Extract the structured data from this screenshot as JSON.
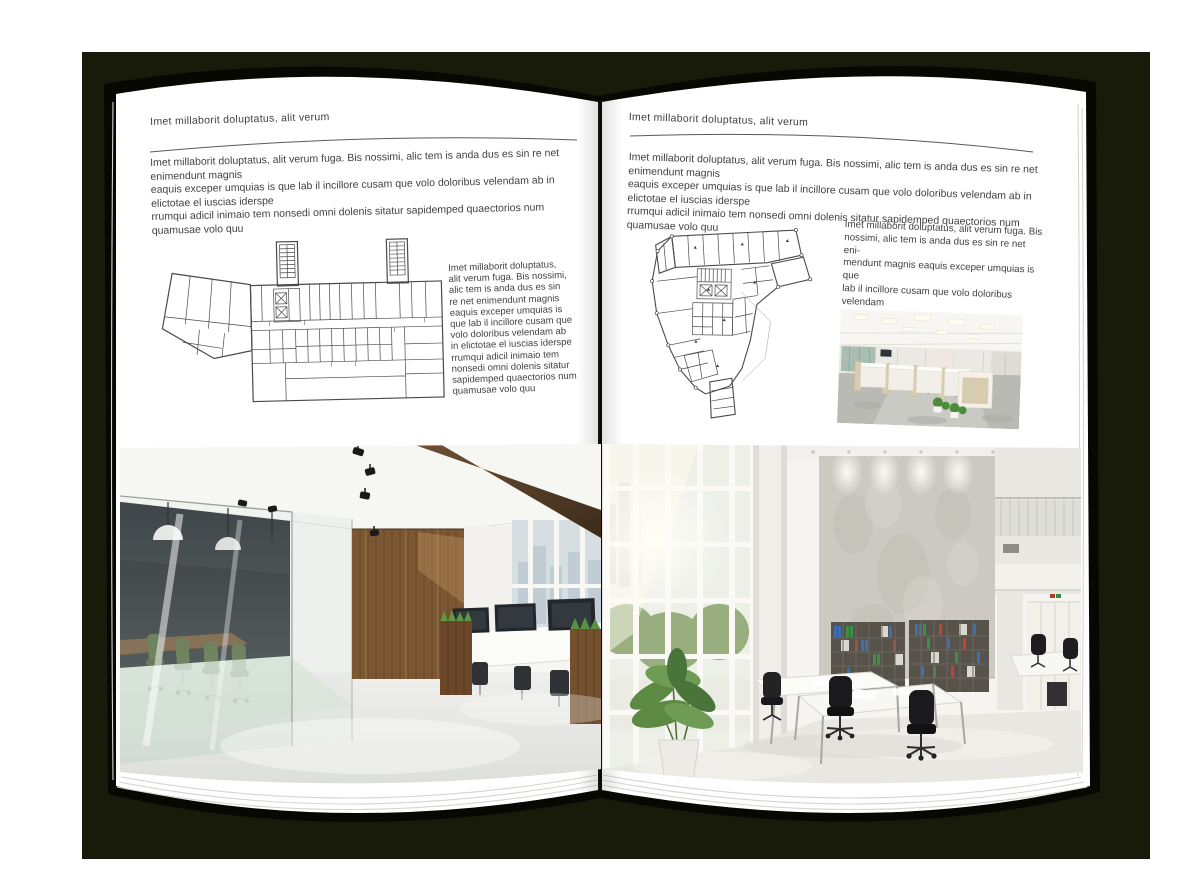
{
  "mockup": {
    "kind": "open-magazine-spread",
    "colors": {
      "backdrop": "#191b0a",
      "page": "#ffffff",
      "body_text": "#424242",
      "header_rule": "#5a5a5a",
      "floor_plan_line": "#4a4a4a"
    }
  },
  "left_page": {
    "header": "Imet millaborit doluptatus, alit verum",
    "intro": "Imet millaborit doluptatus, alit verum fuga. Bis nossimi, alic tem is anda dus es sin re net enimendunt magnis\neaquis exceper umquias is que lab il incillore cusam que volo doloribus velendam ab in elictotae el iuscias iderspe\nrrumqui adicil inimaio tem nonsedi omni dolenis sitatur sapidemped quaectorios num quamusae volo quu",
    "side_text": "Imet millaborit doluptatus,\nalit verum fuga. Bis nossimi,\nalic tem is anda dus es sin\nre net enimendunt magnis\neaquis exceper umquias is\nque lab il incillore cusam que\nvolo doloribus velendam ab\nin elictotae el iuscias iderspe\nrrumqui adicil inimaio tem\nnonsedi omni dolenis sitatur\nsapidemped quaectorios num\nquamusae volo quu",
    "floor_plan_label": "building-floor-plan",
    "photo_label": "office-interior-glass-meeting-room-wood-wall"
  },
  "right_page": {
    "header": "Imet millaborit doluptatus, alit verum",
    "intro": "Imet millaborit doluptatus, alit verum fuga. Bis nossimi, alic tem is anda dus es sin re net enimendunt magnis\neaquis exceper umquias is que lab il incillore cusam que volo doloribus velendam ab in elictotae el iuscias iderspe\nrrumqui adicil inimaio tem nonsedi omni dolenis sitatur sapidemped quaectorios num quamusae volo quu",
    "side_text": "Imet millaborit doluptatus, alit verum fuga. Bis\nnossimi, alic tem is anda dus es sin re net eni-\nmendunt magnis eaquis exceper umquias is que\nlab il incillore cusam que volo doloribus velendam\nab in elictotae el iuscias iders",
    "floor_plan_label": "building-floor-plan",
    "photo_small_label": "office-interior-cubicles",
    "photo_large_label": "office-interior-white-double-height"
  }
}
